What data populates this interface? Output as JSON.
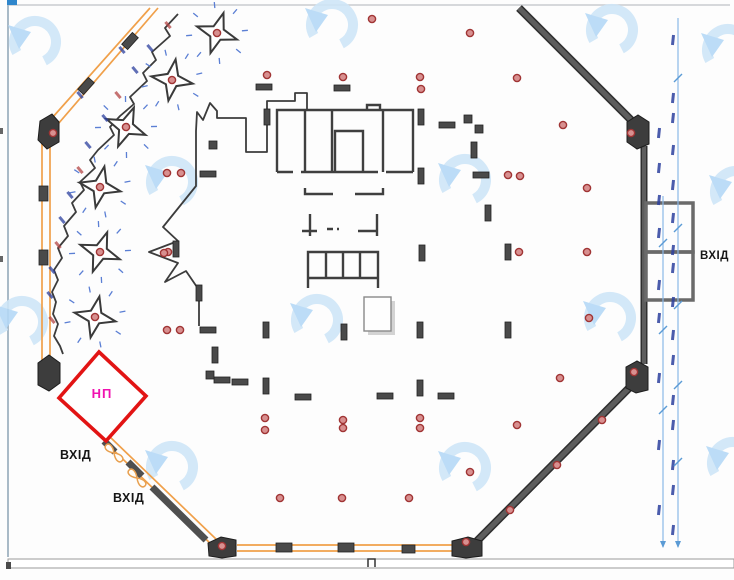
{
  "labels": {
    "np": "НП",
    "entrance_left_upper": "ВХІД",
    "entrance_left_lower": "ВХІД",
    "entrance_right": "ВХІД"
  },
  "colors": {
    "wall_orange": "#f0a04a",
    "wall_dark": "#5d5d5d",
    "wall_edge": "#2f2f2f",
    "block": "#3d3d3d",
    "dot_fill": "#d89090",
    "dot_ring": "#a03434",
    "diamond_red": "#e21414",
    "np_pink": "#f012b0",
    "dim_blue": "#8ab8e8",
    "speck_blue": "#2b3f9e",
    "speck_red": "#b34444",
    "watermark_ring": "#cfe6f8",
    "watermark_tri": "#b5d9f6",
    "star_tick": "#5b7fd4"
  },
  "plan": {
    "watermarks": [
      [
        35,
        42
      ],
      [
        332,
        25
      ],
      [
        612,
        30
      ],
      [
        728,
        50
      ],
      [
        172,
        182
      ],
      [
        465,
        180
      ],
      [
        736,
        192
      ],
      [
        22,
        322
      ],
      [
        317,
        320
      ],
      [
        610,
        318
      ],
      [
        172,
        467
      ],
      [
        465,
        468
      ],
      [
        733,
        463
      ]
    ],
    "red_dots": [
      [
        267,
        75
      ],
      [
        343,
        77
      ],
      [
        420,
        77
      ],
      [
        421,
        89
      ],
      [
        470,
        33
      ],
      [
        517,
        78
      ],
      [
        563,
        125
      ],
      [
        167,
        173
      ],
      [
        181,
        173
      ],
      [
        508,
        175
      ],
      [
        520,
        176
      ],
      [
        587,
        188
      ],
      [
        168,
        252
      ],
      [
        519,
        252
      ],
      [
        587,
        252
      ],
      [
        164,
        253
      ],
      [
        589,
        318
      ],
      [
        167,
        330
      ],
      [
        180,
        330
      ],
      [
        560,
        378
      ],
      [
        265,
        418
      ],
      [
        265,
        430
      ],
      [
        343,
        420
      ],
      [
        343,
        428
      ],
      [
        420,
        418
      ],
      [
        420,
        428
      ],
      [
        517,
        425
      ],
      [
        470,
        472
      ],
      [
        280,
        498
      ],
      [
        342,
        498
      ],
      [
        409,
        498
      ],
      [
        53,
        133
      ],
      [
        631,
        133
      ],
      [
        634,
        372
      ],
      [
        222,
        546
      ],
      [
        466,
        542
      ],
      [
        510,
        510
      ],
      [
        557,
        465
      ],
      [
        602,
        420
      ],
      [
        372,
        19
      ]
    ],
    "columns_h": [
      [
        264,
        87
      ],
      [
        342,
        88
      ],
      [
        447,
        125
      ],
      [
        481,
        175
      ],
      [
        208,
        174
      ],
      [
        208,
        330
      ],
      [
        222,
        380
      ],
      [
        240,
        382
      ],
      [
        303,
        397
      ],
      [
        446,
        396
      ],
      [
        385,
        396
      ]
    ],
    "columns_v": [
      [
        267,
        117
      ],
      [
        421,
        117
      ],
      [
        474,
        150
      ],
      [
        421,
        176
      ],
      [
        488,
        213
      ],
      [
        422,
        253
      ],
      [
        508,
        252
      ],
      [
        176,
        249
      ],
      [
        199,
        293
      ],
      [
        266,
        330
      ],
      [
        344,
        332
      ],
      [
        420,
        330
      ],
      [
        508,
        330
      ],
      [
        215,
        355
      ],
      [
        266,
        386
      ],
      [
        420,
        388
      ]
    ],
    "columns_s": [
      [
        468,
        119
      ],
      [
        479,
        129
      ],
      [
        213,
        145
      ],
      [
        210,
        375
      ]
    ],
    "kiosk_stars": [
      {
        "cx": 217,
        "cy": 33,
        "rot": 18
      },
      {
        "cx": 172,
        "cy": 80,
        "rot": 10
      },
      {
        "cx": 126,
        "cy": 127,
        "rot": 22
      },
      {
        "cx": 100,
        "cy": 187,
        "rot": 12
      },
      {
        "cx": 100,
        "cy": 252,
        "rot": 20
      },
      {
        "cx": 95,
        "cy": 317,
        "rot": 12
      }
    ],
    "zig_specks": [
      [
        168,
        25
      ],
      [
        150,
        48
      ],
      [
        135,
        70
      ],
      [
        118,
        95
      ],
      [
        105,
        118
      ],
      [
        88,
        145
      ],
      [
        80,
        170
      ],
      [
        70,
        195
      ],
      [
        62,
        220
      ],
      [
        58,
        245
      ],
      [
        52,
        270
      ],
      [
        50,
        295
      ],
      [
        52,
        320
      ],
      [
        122,
        50
      ],
      [
        80,
        95
      ]
    ],
    "dim": {
      "line1": {
        "x": 663,
        "y1": 196,
        "y2": 547
      },
      "line2": {
        "x": 678,
        "y1": 18,
        "y2": 547
      },
      "specks": [
        [
          673,
          40
        ],
        [
          673,
          98
        ],
        [
          673,
          118
        ],
        [
          659,
          133
        ],
        [
          673,
          150
        ],
        [
          659,
          168
        ],
        [
          673,
          185
        ],
        [
          659,
          200
        ],
        [
          673,
          218
        ],
        [
          659,
          233
        ],
        [
          673,
          250
        ],
        [
          673,
          268
        ],
        [
          659,
          285
        ],
        [
          673,
          302
        ],
        [
          659,
          318
        ],
        [
          673,
          335
        ],
        [
          673,
          360
        ],
        [
          659,
          378
        ],
        [
          673,
          400
        ],
        [
          673,
          425
        ],
        [
          659,
          445
        ],
        [
          673,
          465
        ],
        [
          673,
          490
        ],
        [
          659,
          510
        ],
        [
          673,
          530
        ]
      ],
      "ticks": [
        [
          678,
          78
        ],
        [
          678,
          228
        ],
        [
          663,
          243
        ],
        [
          678,
          305
        ],
        [
          663,
          330
        ],
        [
          678,
          385
        ],
        [
          663,
          410
        ],
        [
          678,
          462
        ]
      ],
      "arrows": [
        [
          663,
          547
        ],
        [
          678,
          547
        ]
      ]
    },
    "edge_specks": [
      [
        0,
        128
      ],
      [
        0,
        256
      ]
    ]
  }
}
